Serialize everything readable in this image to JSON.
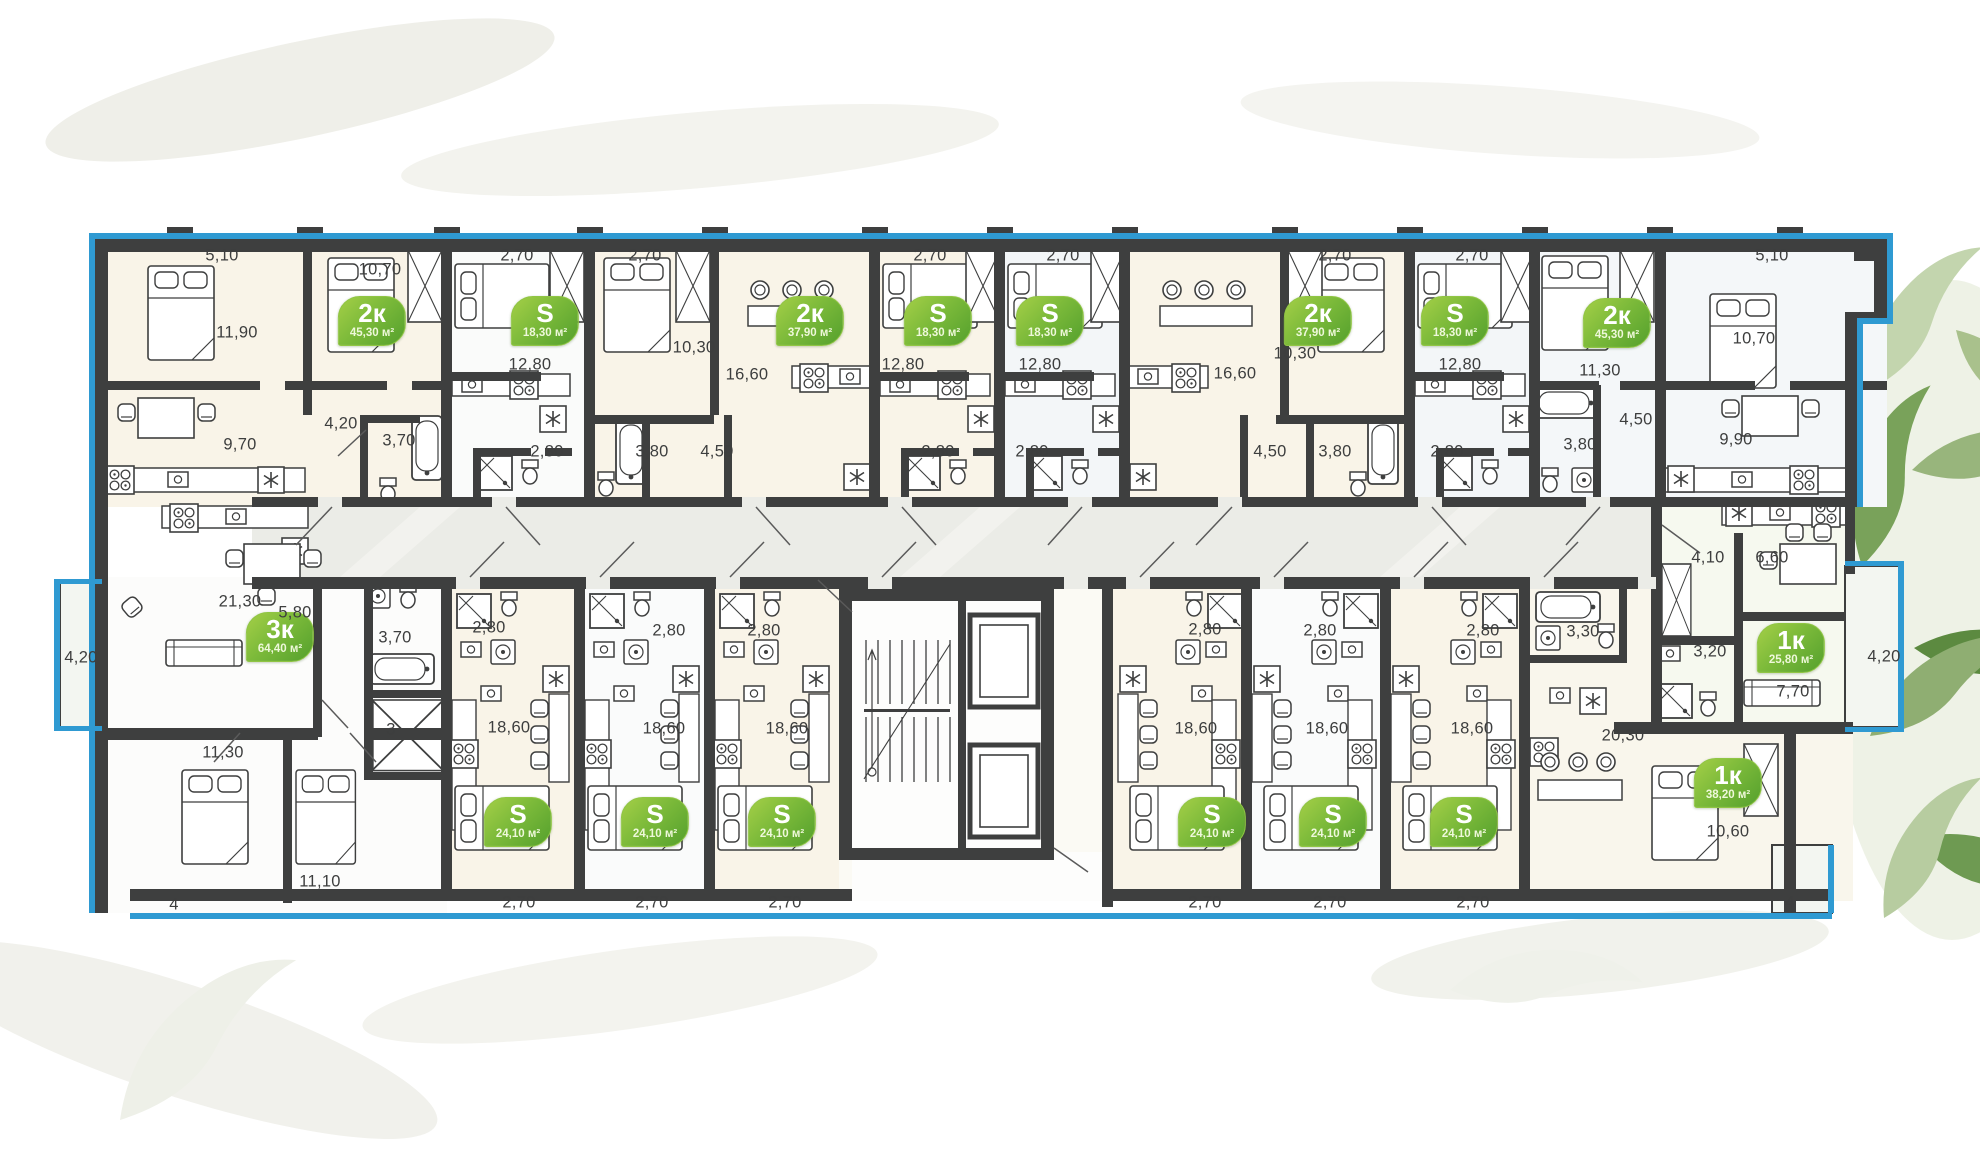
{
  "canvas": {
    "width": 1980,
    "height": 1172,
    "background": "#ffffff"
  },
  "palette": {
    "wall": "#3e3f3f",
    "facade_accent_blue": "#2f9ad2",
    "badge_green_light": "#a4cf47",
    "badge_green_dark": "#54a02d",
    "dimension_text": "#3d3e3e",
    "corridor_fill": "#ebece7",
    "room_warm_fill": "#f9f4e8",
    "room_cool_fill": "#f4f7f9"
  },
  "badges": [
    {
      "type": "2к",
      "area": "45,30 м²",
      "x": 372,
      "y": 321
    },
    {
      "type": "S",
      "area": "18,30 м²",
      "x": 545,
      "y": 321
    },
    {
      "type": "2к",
      "area": "37,90 м²",
      "x": 810,
      "y": 321
    },
    {
      "type": "S",
      "area": "18,30 м²",
      "x": 938,
      "y": 321
    },
    {
      "type": "S",
      "area": "18,30 м²",
      "x": 1050,
      "y": 321
    },
    {
      "type": "2к",
      "area": "37,90 м²",
      "x": 1318,
      "y": 321
    },
    {
      "type": "S",
      "area": "18,30 м²",
      "x": 1455,
      "y": 321
    },
    {
      "type": "2к",
      "area": "45,30 м²",
      "x": 1617,
      "y": 323
    },
    {
      "type": "3к",
      "area": "64,40 м²",
      "x": 280,
      "y": 637
    },
    {
      "type": "S",
      "area": "24,10 м²",
      "x": 518,
      "y": 822
    },
    {
      "type": "S",
      "area": "24,10 м²",
      "x": 655,
      "y": 822
    },
    {
      "type": "S",
      "area": "24,10 м²",
      "x": 782,
      "y": 822
    },
    {
      "type": "S",
      "area": "24,10 м²",
      "x": 1212,
      "y": 822
    },
    {
      "type": "S",
      "area": "24,10 м²",
      "x": 1333,
      "y": 822
    },
    {
      "type": "S",
      "area": "24,10 м²",
      "x": 1464,
      "y": 822
    },
    {
      "type": "1к",
      "area": "25,80 м²",
      "x": 1791,
      "y": 648
    },
    {
      "type": "1к",
      "area": "38,20 м²",
      "x": 1728,
      "y": 783
    }
  ],
  "dimensions": [
    {
      "t": "5,10",
      "x": 222,
      "y": 256
    },
    {
      "t": "11,90",
      "x": 237,
      "y": 333
    },
    {
      "t": "10,70",
      "x": 380,
      "y": 270
    },
    {
      "t": "4,20",
      "x": 341,
      "y": 424
    },
    {
      "t": "3,70",
      "x": 399,
      "y": 441
    },
    {
      "t": "9,70",
      "x": 240,
      "y": 445
    },
    {
      "t": "2,70",
      "x": 517,
      "y": 256
    },
    {
      "t": "12,80",
      "x": 530,
      "y": 365
    },
    {
      "t": "2,80",
      "x": 547,
      "y": 452
    },
    {
      "t": "2,70",
      "x": 645,
      "y": 256
    },
    {
      "t": "10,30",
      "x": 694,
      "y": 348
    },
    {
      "t": "16,60",
      "x": 747,
      "y": 375
    },
    {
      "t": "3,80",
      "x": 652,
      "y": 452
    },
    {
      "t": "4,50",
      "x": 717,
      "y": 452
    },
    {
      "t": "2,70",
      "x": 930,
      "y": 256
    },
    {
      "t": "12,80",
      "x": 903,
      "y": 365
    },
    {
      "t": "2,80",
      "x": 938,
      "y": 452
    },
    {
      "t": "2,70",
      "x": 1063,
      "y": 256
    },
    {
      "t": "12,80",
      "x": 1040,
      "y": 365
    },
    {
      "t": "2,80",
      "x": 1032,
      "y": 452
    },
    {
      "t": "16,60",
      "x": 1235,
      "y": 374
    },
    {
      "t": "2,70",
      "x": 1335,
      "y": 256
    },
    {
      "t": "10,30",
      "x": 1295,
      "y": 354
    },
    {
      "t": "4,50",
      "x": 1270,
      "y": 452
    },
    {
      "t": "3,80",
      "x": 1335,
      "y": 452
    },
    {
      "t": "2,70",
      "x": 1472,
      "y": 256
    },
    {
      "t": "12,80",
      "x": 1460,
      "y": 365
    },
    {
      "t": "2,80",
      "x": 1447,
      "y": 452
    },
    {
      "t": "11,30",
      "x": 1600,
      "y": 371
    },
    {
      "t": "3,80",
      "x": 1580,
      "y": 445
    },
    {
      "t": "4,50",
      "x": 1636,
      "y": 420
    },
    {
      "t": "5,10",
      "x": 1772,
      "y": 256
    },
    {
      "t": "10,70",
      "x": 1754,
      "y": 339
    },
    {
      "t": "9,90",
      "x": 1736,
      "y": 440
    },
    {
      "t": "21,30",
      "x": 240,
      "y": 602
    },
    {
      "t": "5,80",
      "x": 295,
      "y": 613
    },
    {
      "t": "3,70",
      "x": 395,
      "y": 638
    },
    {
      "t": "4,20",
      "x": 81,
      "y": 658
    },
    {
      "t": "3",
      "x": 391,
      "y": 730
    },
    {
      "t": "11,30",
      "x": 223,
      "y": 753
    },
    {
      "t": "11,10",
      "x": 320,
      "y": 882
    },
    {
      "t": "4",
      "x": 174,
      "y": 905
    },
    {
      "t": "2,80",
      "x": 489,
      "y": 628
    },
    {
      "t": "18,60",
      "x": 509,
      "y": 728
    },
    {
      "t": "2,70",
      "x": 519,
      "y": 903
    },
    {
      "t": "2,80",
      "x": 669,
      "y": 631
    },
    {
      "t": "18,60",
      "x": 664,
      "y": 729
    },
    {
      "t": "2,70",
      "x": 652,
      "y": 903
    },
    {
      "t": "2,80",
      "x": 764,
      "y": 631
    },
    {
      "t": "18,60",
      "x": 787,
      "y": 729
    },
    {
      "t": "2,70",
      "x": 785,
      "y": 903
    },
    {
      "t": "2,80",
      "x": 1205,
      "y": 630
    },
    {
      "t": "18,60",
      "x": 1196,
      "y": 729
    },
    {
      "t": "2,70",
      "x": 1205,
      "y": 903
    },
    {
      "t": "2,80",
      "x": 1320,
      "y": 631
    },
    {
      "t": "18,60",
      "x": 1327,
      "y": 729
    },
    {
      "t": "2,70",
      "x": 1330,
      "y": 903
    },
    {
      "t": "2,80",
      "x": 1483,
      "y": 631
    },
    {
      "t": "18,60",
      "x": 1472,
      "y": 729
    },
    {
      "t": "2,70",
      "x": 1473,
      "y": 903
    },
    {
      "t": "3,30",
      "x": 1583,
      "y": 632
    },
    {
      "t": "20,30",
      "x": 1623,
      "y": 736
    },
    {
      "t": "10,60",
      "x": 1728,
      "y": 832
    },
    {
      "t": "4",
      "x": 1790,
      "y": 903
    },
    {
      "t": "4,10",
      "x": 1708,
      "y": 558
    },
    {
      "t": "6,60",
      "x": 1772,
      "y": 558
    },
    {
      "t": "3,20",
      "x": 1710,
      "y": 652
    },
    {
      "t": "7,70",
      "x": 1793,
      "y": 692
    },
    {
      "t": "4,20",
      "x": 1884,
      "y": 657
    }
  ]
}
